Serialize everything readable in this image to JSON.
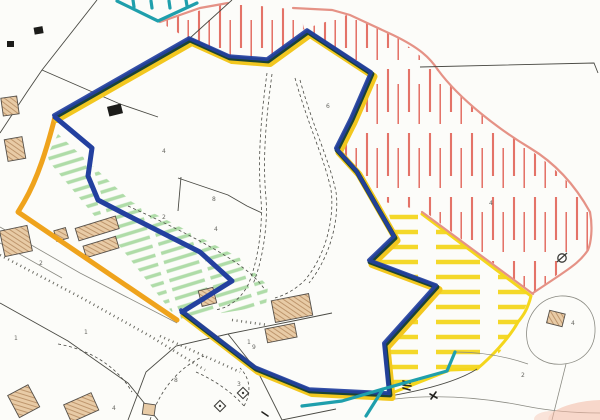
{
  "map": {
    "description": "Scanned cadastral site plan with hand-drawn coloured marker annotations",
    "background": "#fcfcf9",
    "colors": {
      "boundary_blue": "#23409f",
      "boundary_green": "#1c4434",
      "boundary_yellow": "#f2c71f",
      "road_orange": "#efa31c",
      "teal": "#1f9fac",
      "red_hatch": "#e05a4e",
      "salmon_outline": "#e59286",
      "green_hatch": "#a6d9a0",
      "yellow_hatch": "#f4d61d",
      "building_fill": "#e8cba6",
      "building_hatch": "#b3885e",
      "line_dark": "#4a4a44",
      "line_light": "#8a8a82",
      "label_color": "#3f3f3a",
      "pink_smudge": "#f4b9a4",
      "map_bg": "#fcfcf9"
    },
    "regions": [
      {
        "id": "site-boundary",
        "label": "site boundary (navy/dark green over yellow)",
        "color": "#23409f"
      },
      {
        "id": "green-hatch-area",
        "label": "green hatched strip with farm buildings",
        "color": "#a6d9a0"
      },
      {
        "id": "red-hatch-area-north",
        "label": "red hatched land, top centre",
        "color": "#e05a4e"
      },
      {
        "id": "red-hatch-area-east",
        "label": "red hatched land, east",
        "color": "#e05a4e"
      },
      {
        "id": "yellow-hatch-area",
        "label": "yellow hatched land, south east",
        "color": "#f4d61d"
      },
      {
        "id": "teal-boundary-north",
        "label": "teal boundary notch, top",
        "color": "#1f9fac"
      },
      {
        "id": "teal-boundary-south",
        "label": "teal boundary line, bottom",
        "color": "#1f9fac"
      },
      {
        "id": "road-highlight",
        "label": "orange road highlight",
        "color": "#efa31c"
      }
    ],
    "parcel_labels": [
      {
        "t": "4",
        "x": 162,
        "y": 153
      },
      {
        "t": "6",
        "x": 326,
        "y": 108
      },
      {
        "t": "2",
        "x": 162,
        "y": 219
      },
      {
        "t": "2",
        "x": 39,
        "y": 265
      },
      {
        "t": "8",
        "x": 212,
        "y": 201
      },
      {
        "t": "4",
        "x": 214,
        "y": 231
      },
      {
        "t": "1",
        "x": 14,
        "y": 340
      },
      {
        "t": "1",
        "x": 84,
        "y": 334
      },
      {
        "t": "4",
        "x": 112,
        "y": 410
      },
      {
        "t": "1",
        "x": 247,
        "y": 344
      },
      {
        "t": "8",
        "x": 174,
        "y": 382
      },
      {
        "t": "9",
        "x": 252,
        "y": 349
      },
      {
        "t": "4",
        "x": 571,
        "y": 325
      },
      {
        "t": "4",
        "x": 489,
        "y": 205
      },
      {
        "t": "3",
        "x": 237,
        "y": 386
      },
      {
        "t": "2",
        "x": 521,
        "y": 377
      }
    ]
  }
}
